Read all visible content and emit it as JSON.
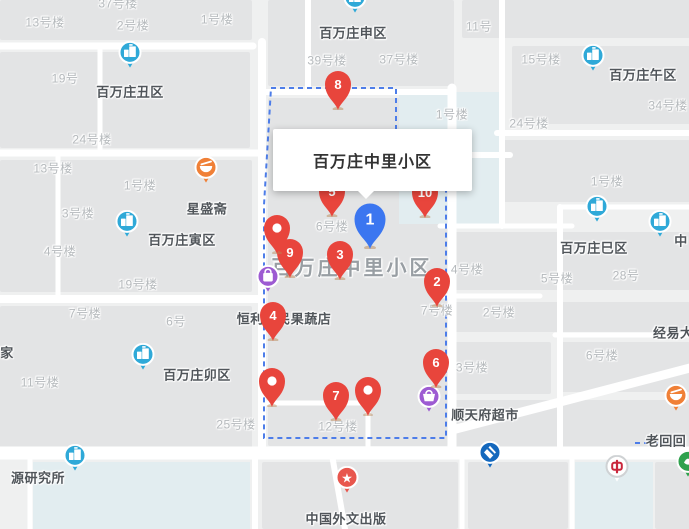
{
  "info_card": {
    "title": "百万庄中里小区"
  },
  "area_label": {
    "text": "百万庄中里小区",
    "x": 352,
    "y": 266
  },
  "colors": {
    "land": "#eff0f0",
    "block": "#e3e4e5",
    "road": "#ffffff",
    "water": "#e2edf0",
    "boundary": "#4d7de9",
    "pin_red": "#e8453c",
    "pin_blue": "#3b76f0",
    "poi_blue": "#2fa9d8",
    "poi_orange": "#f08037",
    "poi_purple": "#9d5bd2",
    "poi_red": "#e8564d",
    "bank_ccb_blue": "#1468bd",
    "bank_boc_red": "#c9273c",
    "bank_green": "#30a14e"
  },
  "pins": [
    {
      "id": "pin-8",
      "label": "8",
      "kind": "numbered",
      "color": "red",
      "x": 338,
      "y": 110
    },
    {
      "id": "pin-5",
      "label": "5",
      "kind": "numbered",
      "color": "red",
      "x": 332,
      "y": 217
    },
    {
      "id": "pin-10",
      "label": "10",
      "kind": "numbered",
      "color": "red",
      "x": 425,
      "y": 218
    },
    {
      "id": "pin-9",
      "label": "9",
      "kind": "numbered",
      "color": "red",
      "x": 290,
      "y": 278
    },
    {
      "id": "pin-dot-a",
      "label": "",
      "kind": "dot",
      "color": "red",
      "x": 277,
      "y": 254
    },
    {
      "id": "pin-1",
      "label": "1",
      "kind": "numbered",
      "color": "blue",
      "x": 370,
      "y": 249
    },
    {
      "id": "pin-3",
      "label": "3",
      "kind": "numbered",
      "color": "red",
      "x": 340,
      "y": 280
    },
    {
      "id": "pin-2",
      "label": "2",
      "kind": "numbered",
      "color": "red",
      "x": 437,
      "y": 307
    },
    {
      "id": "pin-4",
      "label": "4",
      "kind": "numbered",
      "color": "red",
      "x": 273,
      "y": 341
    },
    {
      "id": "pin-6",
      "label": "6",
      "kind": "numbered",
      "color": "red",
      "x": 436,
      "y": 388
    },
    {
      "id": "pin-dot-b",
      "label": "",
      "kind": "dot",
      "color": "red",
      "x": 272,
      "y": 407
    },
    {
      "id": "pin-dot-c",
      "label": "",
      "kind": "dot",
      "color": "red",
      "x": 368,
      "y": 416
    },
    {
      "id": "pin-7",
      "label": "7",
      "kind": "numbered",
      "color": "red",
      "x": 336,
      "y": 421
    }
  ],
  "pois": [
    {
      "id": "poi-baiwanzhuang-chouqu",
      "glyph": "building",
      "color": "poi_blue",
      "x": 130,
      "y": 68,
      "label": "百万庄丑区",
      "lx": 130,
      "ly": 91
    },
    {
      "id": "poi-baiwanzhuang-yinqu",
      "glyph": "building",
      "color": "poi_blue",
      "x": 127,
      "y": 237,
      "label": "百万庄寅区",
      "lx": 182,
      "ly": 239
    },
    {
      "id": "poi-baiwanzhuang-shenqu",
      "glyph": "building",
      "color": "poi_blue",
      "x": 355,
      "y": 13,
      "label": "百万庄申区",
      "lx": 353,
      "ly": 32
    },
    {
      "id": "poi-baiwanzhuang-wuqu",
      "glyph": "building",
      "color": "poi_blue",
      "x": 593,
      "y": 71,
      "label": "百万庄午区",
      "lx": 643,
      "ly": 74
    },
    {
      "id": "poi-baiwanzhuang-siqu",
      "glyph": "building",
      "color": "poi_blue",
      "x": 597,
      "y": 222,
      "label": "百万庄巳区",
      "lx": 594,
      "ly": 247
    },
    {
      "id": "poi-baiwanzhuang-maoqu",
      "glyph": "building",
      "color": "poi_blue",
      "x": 143,
      "y": 370,
      "label": "百万庄卯区",
      "lx": 197,
      "ly": 374
    },
    {
      "id": "poi-partial-right",
      "glyph": "building",
      "color": "poi_blue",
      "x": 660,
      "y": 237,
      "label": "中",
      "lx": 681,
      "ly": 240
    },
    {
      "id": "poi-research-institute",
      "glyph": "building",
      "color": "poi_blue",
      "x": 75,
      "y": 471,
      "label": "源研究所",
      "lx": 38,
      "ly": 477
    },
    {
      "id": "poi-xingshengzhai",
      "glyph": "bowl",
      "color": "poi_orange",
      "x": 206,
      "y": 183,
      "label": "星盛斋",
      "lx": 207,
      "ly": 208
    },
    {
      "id": "poi-laohuihui",
      "glyph": "bowl",
      "color": "poi_orange",
      "x": 676,
      "y": 411,
      "label": "老回回",
      "lx": 666,
      "ly": 440
    },
    {
      "id": "poi-hengli-store",
      "glyph": "bag",
      "color": "poi_purple",
      "x": 268,
      "y": 292,
      "label": "恒利便民果蔬店",
      "lx": 284,
      "ly": 318
    },
    {
      "id": "poi-shuntianfu-market",
      "glyph": "basket",
      "color": "poi_purple",
      "x": 429,
      "y": 412,
      "label": "顺天府超市",
      "lx": 485,
      "ly": 414
    },
    {
      "id": "poi-foreign-press",
      "glyph": "star",
      "color": "poi_red",
      "x": 347,
      "y": 493,
      "label": "中国外文出版",
      "lx": 346,
      "ly": 518
    },
    {
      "id": "poi-bank-ccb",
      "glyph": "ccb",
      "color": "bank_ccb_blue",
      "x": 490,
      "y": 468,
      "label": "",
      "lx": 0,
      "ly": 0
    },
    {
      "id": "poi-bank-boc",
      "glyph": "boc",
      "color": "bank_boc_red",
      "x": 617,
      "y": 482,
      "label": "",
      "lx": 0,
      "ly": 0
    },
    {
      "id": "poi-bank-green",
      "glyph": "leaf",
      "color": "bank_green",
      "x": 688,
      "y": 477,
      "label": "",
      "lx": 0,
      "ly": 0
    }
  ],
  "building_labels": [
    {
      "t": "37号楼",
      "x": 118,
      "y": 3
    },
    {
      "t": "13号楼",
      "x": 45,
      "y": 22
    },
    {
      "t": "2号楼",
      "x": 133,
      "y": 25
    },
    {
      "t": "1号楼",
      "x": 217,
      "y": 19
    },
    {
      "t": "19号",
      "x": 65,
      "y": 78
    },
    {
      "t": "24号楼",
      "x": 92,
      "y": 139
    },
    {
      "t": "13号楼",
      "x": 53,
      "y": 168
    },
    {
      "t": "1号楼",
      "x": 140,
      "y": 185
    },
    {
      "t": "3号楼",
      "x": 78,
      "y": 213
    },
    {
      "t": "4号楼",
      "x": 60,
      "y": 251
    },
    {
      "t": "19号楼",
      "x": 138,
      "y": 284
    },
    {
      "t": "7号楼",
      "x": 85,
      "y": 313
    },
    {
      "t": "6号",
      "x": 176,
      "y": 321
    },
    {
      "t": "11号楼",
      "x": 40,
      "y": 382
    },
    {
      "t": "25号楼",
      "x": 236,
      "y": 424
    },
    {
      "t": "39号楼",
      "x": 327,
      "y": 60
    },
    {
      "t": "37号楼",
      "x": 399,
      "y": 59
    },
    {
      "t": "11号",
      "x": 479,
      "y": 26
    },
    {
      "t": "15号楼",
      "x": 541,
      "y": 59
    },
    {
      "t": "34号楼",
      "x": 668,
      "y": 105
    },
    {
      "t": "1号楼",
      "x": 452,
      "y": 114
    },
    {
      "t": "24号楼",
      "x": 529,
      "y": 123
    },
    {
      "t": "1号楼",
      "x": 607,
      "y": 181
    },
    {
      "t": "6号楼",
      "x": 332,
      "y": 226
    },
    {
      "t": "4号楼",
      "x": 467,
      "y": 269
    },
    {
      "t": "7号楼",
      "x": 437,
      "y": 310
    },
    {
      "t": "5号楼",
      "x": 557,
      "y": 278
    },
    {
      "t": "28号",
      "x": 626,
      "y": 275
    },
    {
      "t": "2号楼",
      "x": 499,
      "y": 312
    },
    {
      "t": "6号楼",
      "x": 602,
      "y": 355
    },
    {
      "t": "3号楼",
      "x": 472,
      "y": 367
    },
    {
      "t": "12号楼",
      "x": 338,
      "y": 426
    }
  ],
  "place_labels": [
    {
      "t": "家",
      "x": 7,
      "y": 352
    },
    {
      "t": "经易大厦",
      "x": 680,
      "y": 332
    }
  ]
}
